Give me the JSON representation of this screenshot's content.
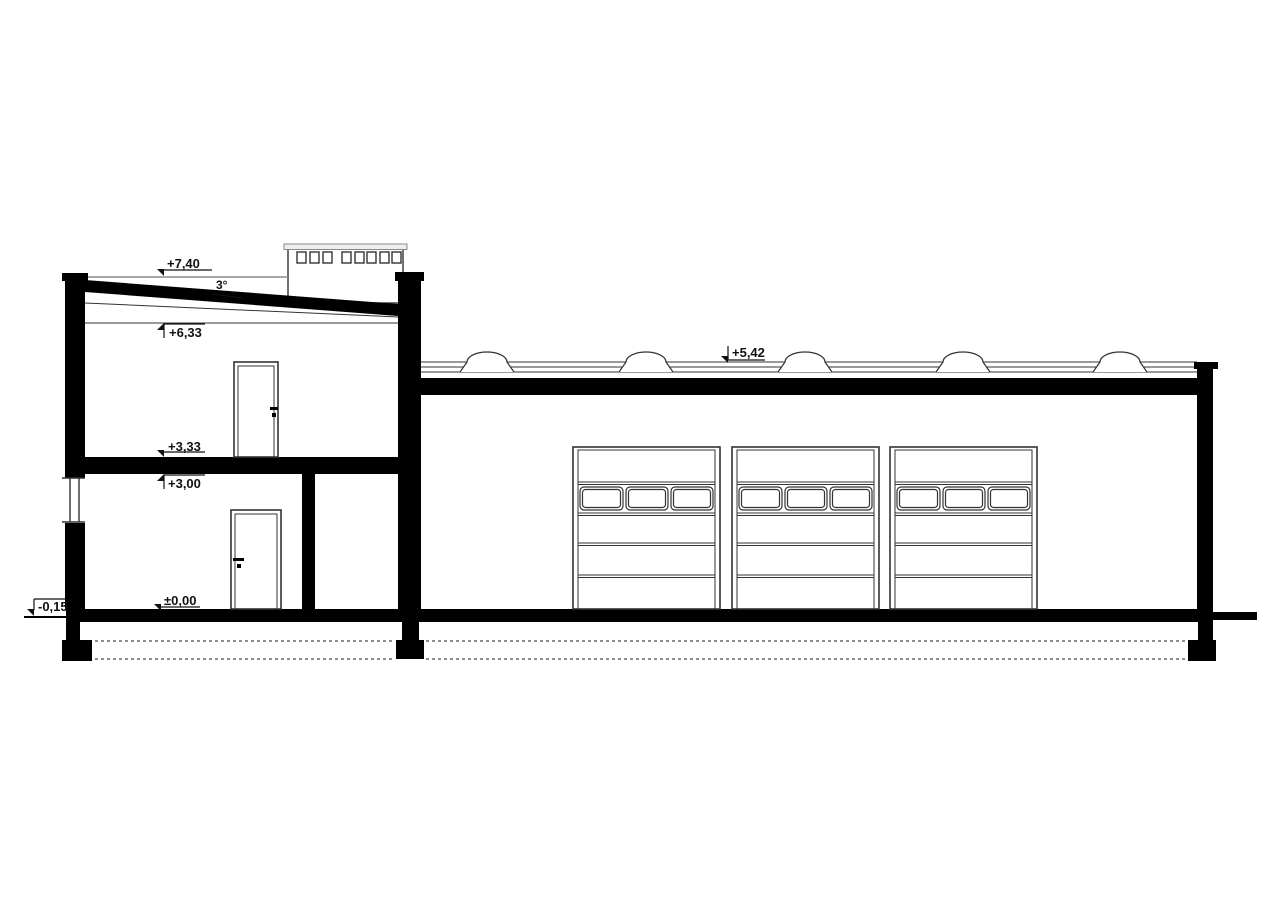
{
  "page": {
    "background": "#ffffff",
    "ink": "#000000",
    "thin_line": "#333333",
    "gray_line": "#8a8a8a"
  },
  "drawing": {
    "kind": "building-cross-section",
    "left_block": "two-storey section with parapet roof",
    "right_block": "single-storey hall with flat roof, dome skylights and sectional doors"
  },
  "annotations": {
    "parapet_level": "+7,40",
    "roof_slope": "3°",
    "upper_ceiling_level": "+6,33",
    "upper_floor_level": "+3,33",
    "ground_ceiling_level": "+3,00",
    "ground_floor_level": "±0,00",
    "site_grade_level": "-0,15",
    "hall_roof_level": "+5,42"
  },
  "features": {
    "skylight_dome_count": 5,
    "sectional_door_count": 3,
    "window_panes_per_sectional_door": 3,
    "roof_vent_count": 8,
    "interior_door_count": 2,
    "facade_window_count": 1
  }
}
